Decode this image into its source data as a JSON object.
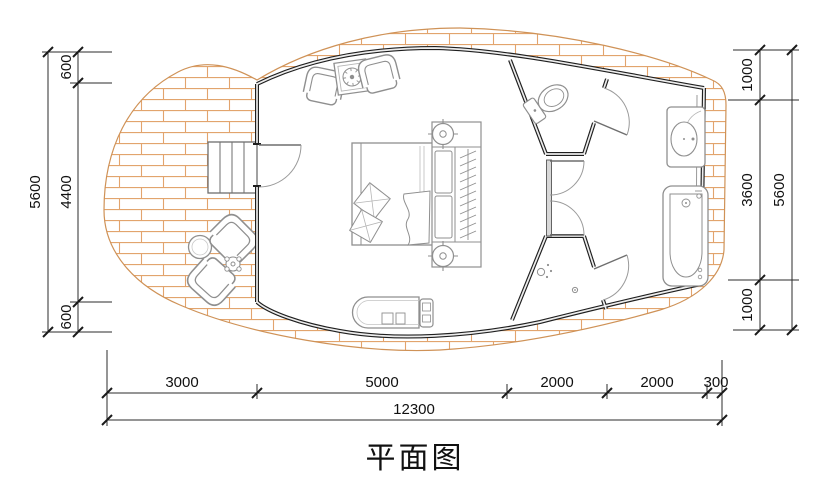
{
  "title": {
    "text": "平面图"
  },
  "drawing": {
    "type": "floor-plan",
    "elements": [
      "deck",
      "cabin",
      "bedroom",
      "toilet-room",
      "shower-room",
      "bathroom"
    ]
  },
  "colors": {
    "wall": "#1f1f1f",
    "deck_brick": "#dfa268",
    "furniture": "#8f8f8f",
    "dimension_line": "#2b2b2b",
    "dimension_text": "#111111",
    "paper": "#ffffff"
  },
  "dimensions": {
    "left_outer_total": "5600",
    "left_segments": [
      "600",
      "4400",
      "600"
    ],
    "right_segments": [
      "1000",
      "3600",
      "1000"
    ],
    "right_outer_total": "5600",
    "bottom_segments": [
      "3000",
      "5000",
      "2000",
      "2000",
      "300"
    ],
    "bottom_total": "12300"
  }
}
